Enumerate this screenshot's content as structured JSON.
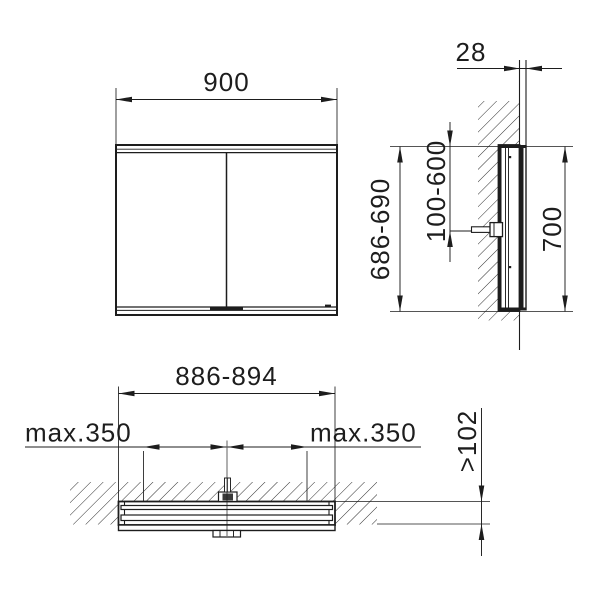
{
  "drawing": {
    "views": {
      "front": {
        "width": "900"
      },
      "side": {
        "protrusion": "28",
        "recess_height": "686-690",
        "mounting_height": "100-600",
        "height": "700"
      },
      "plan": {
        "recess_width": "886-894",
        "hinge_left": "max.350",
        "hinge_right": "max.350",
        "recess_depth": ">102"
      }
    },
    "colors": {
      "line": "#1d1d1d",
      "background": "#ffffff",
      "hatch": "#2b2b2b"
    }
  }
}
